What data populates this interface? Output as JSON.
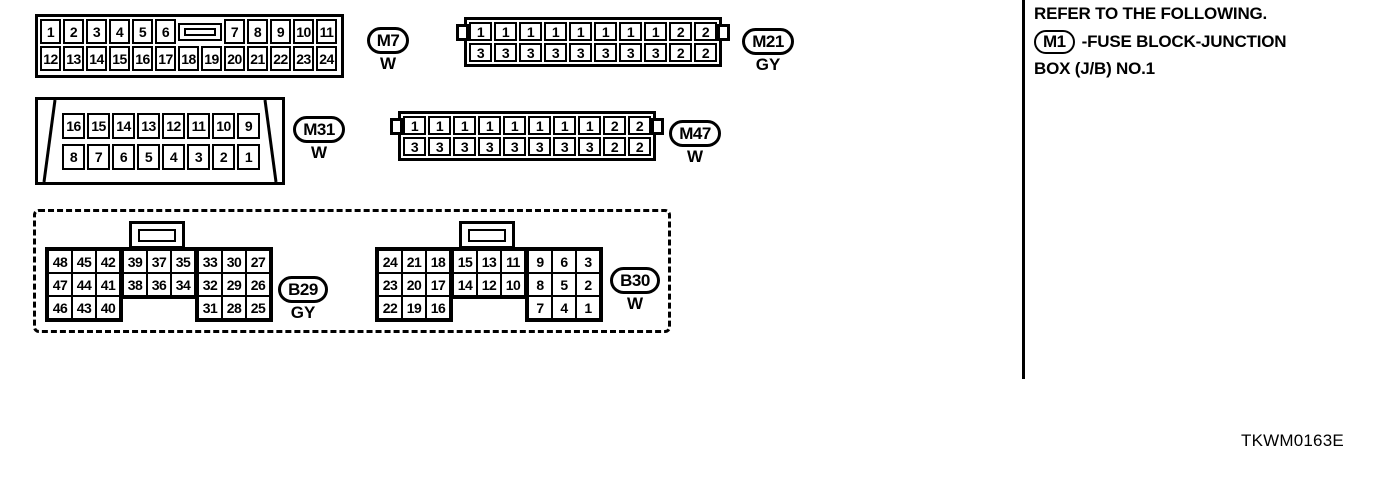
{
  "connectors": {
    "m7": {
      "label": "M7",
      "color_code": "W",
      "pins_top_left": [
        "1",
        "2",
        "3",
        "4",
        "5",
        "6"
      ],
      "pins_top_right": [
        "7",
        "8",
        "9",
        "10",
        "11"
      ],
      "pins_bottom": [
        "12",
        "13",
        "14",
        "15",
        "16",
        "17",
        "18",
        "19",
        "20",
        "21",
        "22",
        "23",
        "24"
      ]
    },
    "m21": {
      "label": "M21",
      "color_code": "GY",
      "pins_top": [
        "1",
        "1",
        "1",
        "1",
        "1",
        "1",
        "1",
        "1",
        "2",
        "2"
      ],
      "pins_bottom": [
        "3",
        "3",
        "3",
        "3",
        "3",
        "3",
        "3",
        "3",
        "2",
        "2"
      ]
    },
    "m31": {
      "label": "M31",
      "color_code": "W",
      "pins_top": [
        "16",
        "15",
        "14",
        "13",
        "12",
        "11",
        "10",
        "9"
      ],
      "pins_bottom": [
        "8",
        "7",
        "6",
        "5",
        "4",
        "3",
        "2",
        "1"
      ]
    },
    "m47": {
      "label": "M47",
      "color_code": "W",
      "pins_top": [
        "1",
        "1",
        "1",
        "1",
        "1",
        "1",
        "1",
        "1",
        "2",
        "2"
      ],
      "pins_bottom": [
        "3",
        "3",
        "3",
        "3",
        "3",
        "3",
        "3",
        "3",
        "2",
        "2"
      ]
    },
    "b29": {
      "label": "B29",
      "color_code": "GY",
      "left_block": [
        [
          "48",
          "45",
          "42"
        ],
        [
          "47",
          "44",
          "41"
        ],
        [
          "46",
          "43",
          "40"
        ]
      ],
      "middle_block": [
        [
          "39",
          "37",
          "35"
        ],
        [
          "38",
          "36",
          "34"
        ]
      ],
      "right_block": [
        [
          "33",
          "30",
          "27"
        ],
        [
          "32",
          "29",
          "26"
        ],
        [
          "31",
          "28",
          "25"
        ]
      ]
    },
    "b30": {
      "label": "B30",
      "color_code": "W",
      "left_block": [
        [
          "24",
          "21",
          "18"
        ],
        [
          "23",
          "20",
          "17"
        ],
        [
          "22",
          "19",
          "16"
        ]
      ],
      "middle_block": [
        [
          "15",
          "13",
          "11"
        ],
        [
          "14",
          "12",
          "10"
        ]
      ],
      "right_block": [
        [
          "9",
          "6",
          "3"
        ],
        [
          "8",
          "5",
          "2"
        ],
        [
          "7",
          "4",
          "1"
        ]
      ]
    }
  },
  "note": {
    "line1": "REFER TO THE FOLLOWING.",
    "ref_label": "M1",
    "ref_text_line1": "-FUSE BLOCK-JUNCTION",
    "ref_text_line2": "BOX (J/B) NO.1"
  },
  "figure_code": "TKWM0163E"
}
